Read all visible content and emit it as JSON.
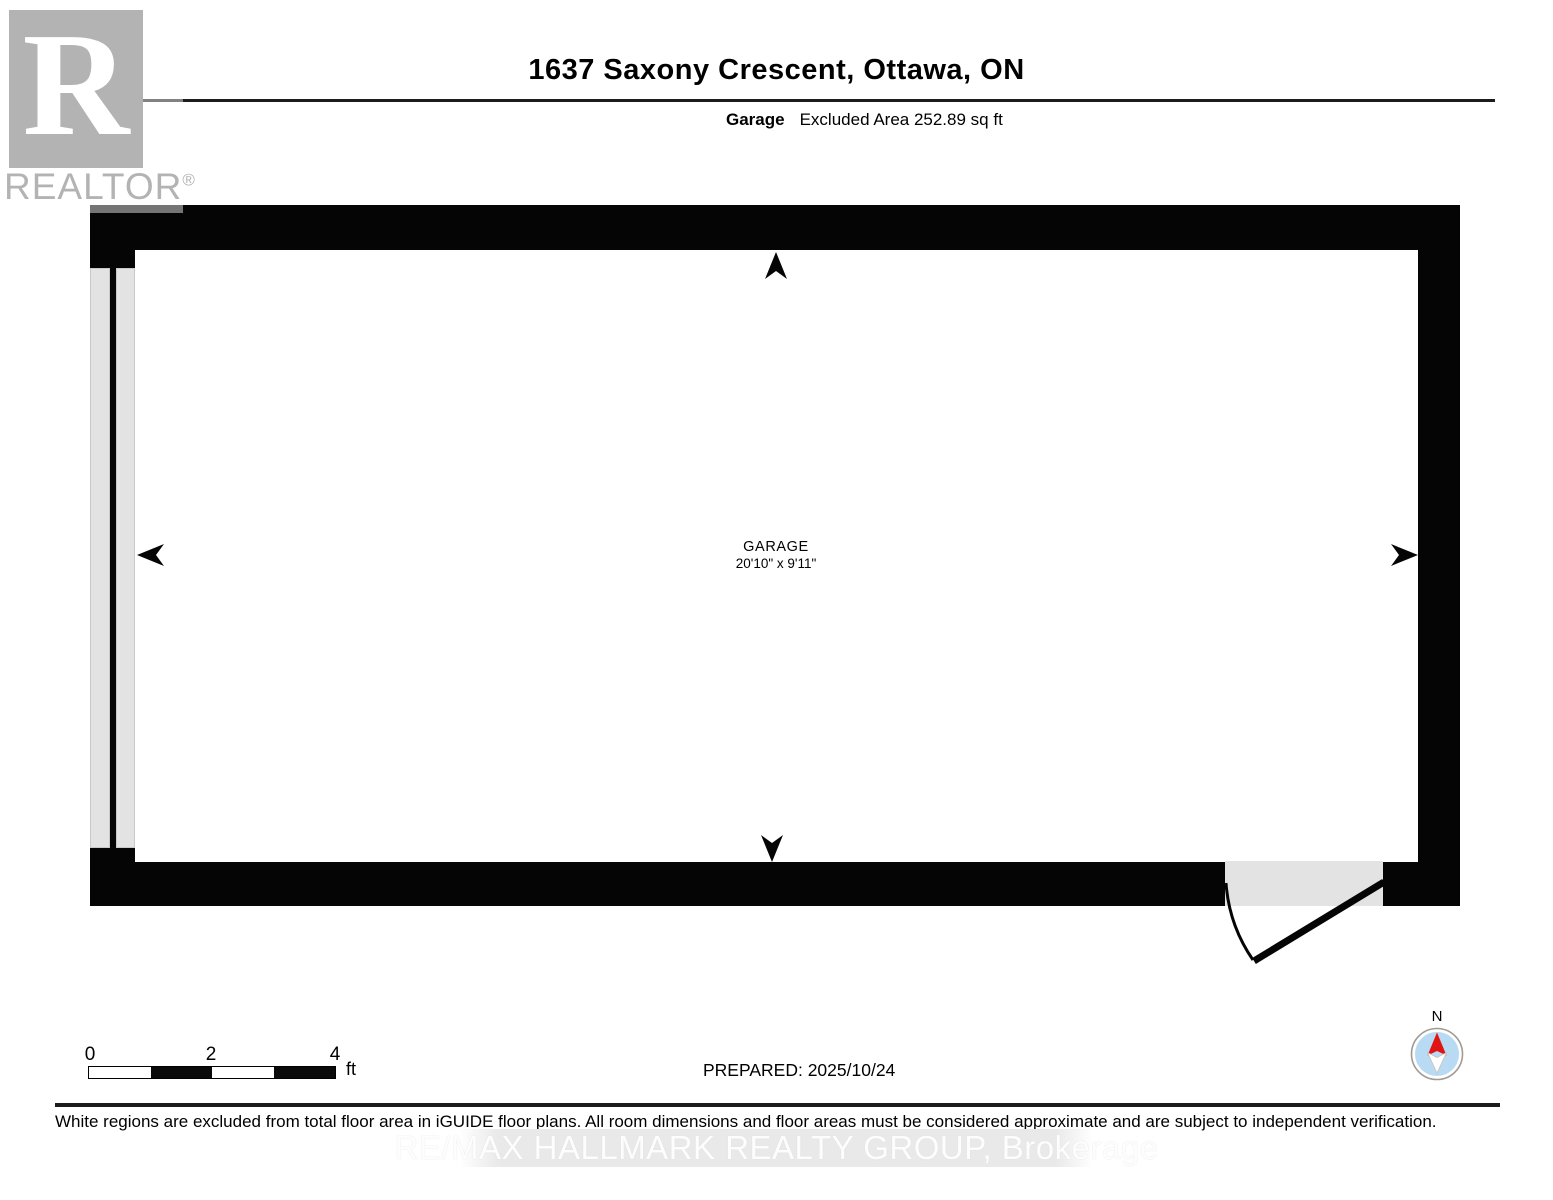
{
  "header": {
    "title": "1637 Saxony Crescent, Ottawa, ON",
    "floor_label": "Garage",
    "floor_area": "Excluded Area 252.89 sq ft"
  },
  "watermarks": {
    "realtor_logo_letter": "R",
    "realtor_text": "REALTOR",
    "registered_mark": "®",
    "brokerage": "RE/MAX HALLMARK REALTY GROUP, Brokerage"
  },
  "floorplan": {
    "room_name": "GARAGE",
    "room_dimensions": "20'10\" x 9'11\""
  },
  "footer": {
    "scale": {
      "ticks": [
        "0",
        "2",
        "4"
      ],
      "unit": "ft"
    },
    "prepared": "PREPARED: 2025/10/24",
    "compass_label": "N",
    "disclaimer": "White regions are excluded from total floor area in iGUIDE floor plans. All room dimensions and floor areas must be considered approximate and are subject to independent verification."
  },
  "colors": {
    "wall": "#050505",
    "garage_door_fill": "#e3e3e3",
    "door_opening_fill": "#e3e3e3",
    "compass_blue": "#b8daf2",
    "compass_red": "#e01414",
    "watermark_gray": "#b3b3b3",
    "brokerage_band": "#e9e9e9"
  }
}
